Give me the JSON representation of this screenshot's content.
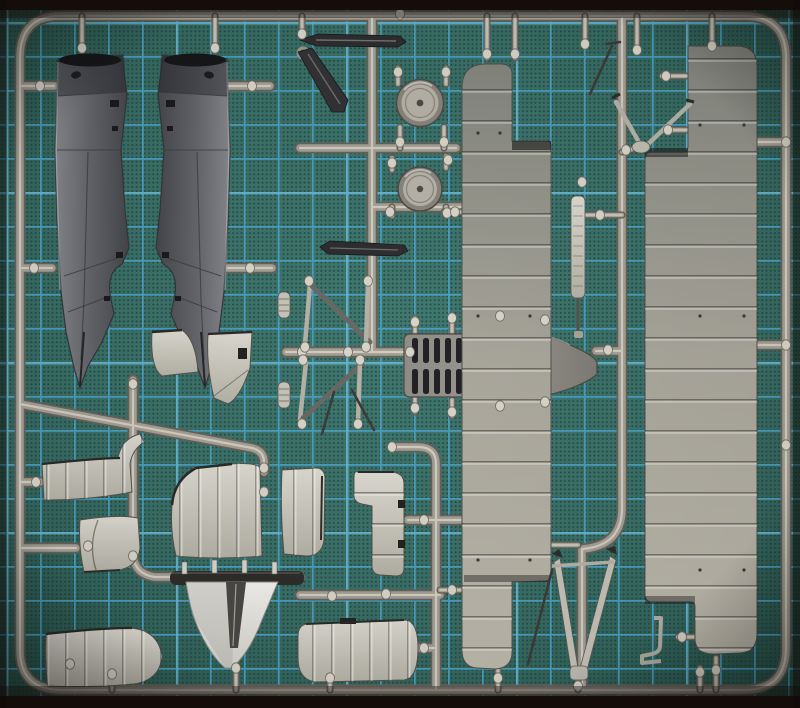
{
  "photo": {
    "subject": "grey injection-molded model aircraft parts sprue",
    "surface": "green-teal self-healing cutting mat with blue square grid",
    "text_content": "none"
  },
  "colors": {
    "photo_edge": "#140d0a",
    "mat_center": "#407870",
    "mat_mid": "#3a6f67",
    "mat_dark": "#27514a",
    "mat_dot": "#1f453d",
    "grid": "#4aa3c7",
    "grid_bright": "#7cc6df",
    "runner_dark": "#66625a",
    "runner_mid": "#a39f95",
    "runner_highlight": "#d8d4c8",
    "gate": "#d8d4c9",
    "fuselage_light": "#85878c",
    "fuselage_dark": "#45464a",
    "blade_dark": "#2e2e30",
    "part_mid": "#928f88",
    "part_light": "#c6c3b8",
    "part_white": "#f2f1ee",
    "wing_top": "#84867e",
    "wing_mid": "#a9a69b",
    "wing_bottom": "#bcb8ac",
    "slot_dark": "#222226",
    "wheel_face": "#b6b2a7",
    "fin_bar_dark": "#2f2d2a"
  },
  "parts": [
    {
      "id": "fuselage-half-left",
      "label": "fuselage half, left"
    },
    {
      "id": "fuselage-half-right",
      "label": "fuselage half, right"
    },
    {
      "id": "tail-fin-panel-small",
      "label": "small tail fin panel"
    },
    {
      "id": "rudder-panel",
      "label": "rudder panel"
    },
    {
      "id": "propeller-blade",
      "label": "dark propeller / strut blade"
    },
    {
      "id": "strut-blade-lower",
      "label": "dark axle wing blade"
    },
    {
      "id": "wheel-upper",
      "label": "wheel disc, upper"
    },
    {
      "id": "wheel-lower",
      "label": "wheel disc, lower"
    },
    {
      "id": "cabane-struts-upper",
      "label": "N cabane strut set, upper"
    },
    {
      "id": "cabane-struts-lower",
      "label": "N cabane strut set, lower"
    },
    {
      "id": "engine-deck-louvered",
      "label": "louvered engine deck / fuselage belly"
    },
    {
      "id": "wing-panel-left",
      "label": "large ribbed wing panel, left"
    },
    {
      "id": "wing-panel-right",
      "label": "large ribbed wing panel, right"
    },
    {
      "id": "wingtip-fairing",
      "label": "wingtip fairing with hook"
    },
    {
      "id": "cowl-panel-small",
      "label": "small cowl panel"
    },
    {
      "id": "cowl-panel-large",
      "label": "large curved cowl panel"
    },
    {
      "id": "cowl-panel-right",
      "label": "curved cowl panel, right half"
    },
    {
      "id": "aileron-panel-vertical",
      "label": "vertical ribbed aileron panel"
    },
    {
      "id": "lower-wing-left",
      "label": "lower wing piece, bottom left"
    },
    {
      "id": "lower-wing-right",
      "label": "lower wing piece, bottom center"
    },
    {
      "id": "tail-fin-white",
      "label": "bright white tail fin"
    },
    {
      "id": "landing-gear-v-strut",
      "label": "landing gear V strut"
    },
    {
      "id": "cabane-a-frame",
      "label": "A-frame strut"
    },
    {
      "id": "tail-skid",
      "label": "tail skid strip"
    },
    {
      "id": "bracket-small",
      "label": "small L bracket"
    },
    {
      "id": "sprue-frame",
      "label": "sprue runner frame"
    },
    {
      "id": "cutting-mat",
      "label": "cutting mat background"
    }
  ]
}
